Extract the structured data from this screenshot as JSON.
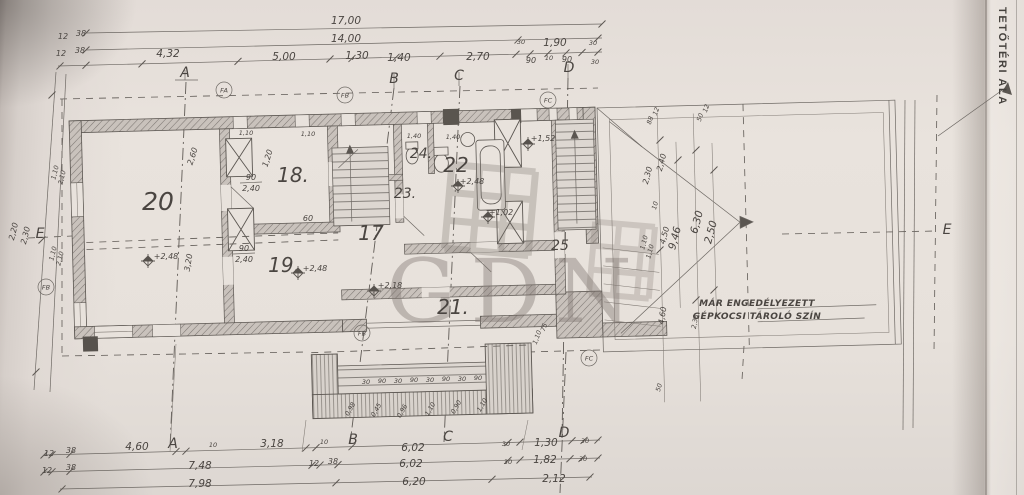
{
  "sheet": {
    "side_title": "TETŐTÉRI ALA",
    "watermark": "GDN"
  },
  "plan": {
    "texts": [
      {
        "t": "17,00",
        "x": 346,
        "y": 24,
        "s": "m"
      },
      {
        "t": "14,00",
        "x": 346,
        "y": 42,
        "s": "m"
      },
      {
        "t": "4,32",
        "x": 168,
        "y": 57,
        "s": "m"
      },
      {
        "t": "5,00",
        "x": 284,
        "y": 60,
        "s": "m"
      },
      {
        "t": "1,30",
        "x": 357,
        "y": 59,
        "s": "m"
      },
      {
        "t": "1,40",
        "x": 399,
        "y": 61,
        "s": "m"
      },
      {
        "t": "2,70",
        "x": 478,
        "y": 60,
        "s": "m"
      },
      {
        "t": "1,90",
        "x": 555,
        "y": 46,
        "s": "m"
      },
      {
        "t": "30",
        "x": 521,
        "y": 44,
        "s": "xs"
      },
      {
        "t": "30",
        "x": 593,
        "y": 45,
        "s": "xs"
      },
      {
        "t": "90",
        "x": 531,
        "y": 63,
        "s": "s"
      },
      {
        "t": "10",
        "x": 549,
        "y": 60,
        "s": "xs"
      },
      {
        "t": "90",
        "x": 567,
        "y": 62,
        "s": "s"
      },
      {
        "t": "30",
        "x": 595,
        "y": 64,
        "s": "xs"
      },
      {
        "t": "12",
        "x": 63,
        "y": 39,
        "s": "s"
      },
      {
        "t": "38",
        "x": 81,
        "y": 36,
        "s": "s"
      },
      {
        "t": "12",
        "x": 61,
        "y": 56,
        "s": "s"
      },
      {
        "t": "38",
        "x": 80,
        "y": 53,
        "s": "s"
      },
      {
        "t": "A",
        "x": 185,
        "y": 77,
        "s": "l"
      },
      {
        "t": "B",
        "x": 394,
        "y": 83,
        "s": "l"
      },
      {
        "t": "C",
        "x": 459,
        "y": 80,
        "s": "l"
      },
      {
        "t": "D",
        "x": 569,
        "y": 72,
        "s": "l"
      },
      {
        "t": "A",
        "x": 173,
        "y": 448,
        "s": "l"
      },
      {
        "t": "B",
        "x": 353,
        "y": 444,
        "s": "l"
      },
      {
        "t": "C",
        "x": 448,
        "y": 441,
        "s": "l"
      },
      {
        "t": "D",
        "x": 564,
        "y": 437,
        "s": "l"
      },
      {
        "t": "E",
        "x": 40,
        "y": 238,
        "s": "l"
      },
      {
        "t": "E",
        "x": 947,
        "y": 234,
        "s": "l"
      },
      {
        "t": "20",
        "x": 158,
        "y": 210,
        "s": "xxl"
      },
      {
        "t": "18.",
        "x": 293,
        "y": 182,
        "s": "xl"
      },
      {
        "t": "19.",
        "x": 284,
        "y": 272,
        "s": "xl"
      },
      {
        "t": "17",
        "x": 371,
        "y": 240,
        "s": "xl"
      },
      {
        "t": "21.",
        "x": 453,
        "y": 314,
        "s": "xl"
      },
      {
        "t": "22",
        "x": 456,
        "y": 172,
        "s": "xl"
      },
      {
        "t": "23.",
        "x": 405,
        "y": 198,
        "s": "l"
      },
      {
        "t": "24.",
        "x": 421,
        "y": 158,
        "s": "l"
      },
      {
        "t": "25",
        "x": 560,
        "y": 250,
        "s": "l"
      },
      {
        "t": "+2,48",
        "x": 166,
        "y": 259,
        "s": "s"
      },
      {
        "t": "+2,48",
        "x": 315,
        "y": 271,
        "s": "s"
      },
      {
        "t": "+2,18",
        "x": 390,
        "y": 288,
        "s": "s"
      },
      {
        "t": "+1,52",
        "x": 543,
        "y": 141,
        "s": "s"
      },
      {
        "t": "+1,02",
        "x": 501,
        "y": 215,
        "s": "s"
      },
      {
        "t": "+2,48",
        "x": 472,
        "y": 184,
        "s": "s"
      },
      {
        "t": "2,60",
        "x": 195,
        "y": 157,
        "r": -72,
        "s": "s"
      },
      {
        "t": "1,20",
        "x": 270,
        "y": 159,
        "r": -72,
        "s": "s"
      },
      {
        "t": "3,20",
        "x": 191,
        "y": 263,
        "r": -80,
        "s": "s"
      },
      {
        "t": "60",
        "x": 308,
        "y": 221,
        "s": "s"
      },
      {
        "t": "1,40",
        "x": 414,
        "y": 138,
        "s": "xs"
      },
      {
        "t": "1,40",
        "x": 453,
        "y": 139,
        "s": "xs"
      },
      {
        "t": "1,10",
        "x": 246,
        "y": 135,
        "s": "xs"
      },
      {
        "t": "1,10",
        "x": 308,
        "y": 136,
        "s": "xs"
      },
      {
        "t": "1,10",
        "x": 539,
        "y": 338,
        "r": -70,
        "s": "xs"
      },
      {
        "t": "75",
        "x": 546,
        "y": 328,
        "r": -70,
        "s": "xs"
      },
      {
        "t": "2,20",
        "x": 16,
        "y": 232,
        "r": -76,
        "s": "s"
      },
      {
        "t": "2,30",
        "x": 28,
        "y": 236,
        "r": -76,
        "s": "s"
      },
      {
        "t": "1,10",
        "x": 57,
        "y": 173,
        "r": -76,
        "s": "xs"
      },
      {
        "t": "2,10",
        "x": 64,
        "y": 178,
        "r": -76,
        "s": "xs"
      },
      {
        "t": "1,10",
        "x": 55,
        "y": 254,
        "r": -76,
        "s": "xs"
      },
      {
        "t": "2,10",
        "x": 62,
        "y": 259,
        "r": -76,
        "s": "xs"
      },
      {
        "t": "2,30",
        "x": 650,
        "y": 176,
        "r": -75,
        "s": "s"
      },
      {
        "t": "2,40",
        "x": 664,
        "y": 163,
        "r": -75,
        "s": "s"
      },
      {
        "t": "6,30",
        "x": 700,
        "y": 223,
        "r": -75,
        "s": "m"
      },
      {
        "t": "2,50",
        "x": 714,
        "y": 233,
        "r": -75,
        "s": "m"
      },
      {
        "t": "9,46",
        "x": 678,
        "y": 239,
        "r": -75,
        "s": "m"
      },
      {
        "t": "4,50",
        "x": 667,
        "y": 236,
        "r": -75,
        "s": "s"
      },
      {
        "t": "1,10",
        "x": 646,
        "y": 243,
        "r": -75,
        "s": "xs"
      },
      {
        "t": "1,10",
        "x": 652,
        "y": 252,
        "r": -75,
        "s": "xs"
      },
      {
        "t": "10",
        "x": 657,
        "y": 206,
        "r": -75,
        "s": "xs"
      },
      {
        "t": "4,60",
        "x": 665,
        "y": 316,
        "r": -80,
        "s": "s"
      },
      {
        "t": "2,38",
        "x": 697,
        "y": 322,
        "r": -80,
        "s": "xs"
      },
      {
        "t": "50",
        "x": 661,
        "y": 388,
        "r": -75,
        "s": "xs"
      },
      {
        "t": "88",
        "x": 652,
        "y": 121,
        "r": -70,
        "s": "xs"
      },
      {
        "t": "12",
        "x": 658,
        "y": 112,
        "r": -70,
        "s": "xs"
      },
      {
        "t": "50",
        "x": 702,
        "y": 118,
        "r": -70,
        "s": "xs"
      },
      {
        "t": "12",
        "x": 708,
        "y": 109,
        "r": -70,
        "s": "xs"
      },
      {
        "t": "MÁR ENGEDÉLYEZETT",
        "x": 757,
        "y": 306,
        "s": "note",
        "a": "start"
      },
      {
        "t": "GÉPKOCSI TÁROLÓ SZÍN",
        "x": 757,
        "y": 319,
        "s": "note",
        "a": "start"
      },
      {
        "t": "12",
        "x": 49,
        "y": 456,
        "s": "s"
      },
      {
        "t": "38",
        "x": 71,
        "y": 453,
        "s": "s"
      },
      {
        "t": "4,60",
        "x": 137,
        "y": 450,
        "s": "m"
      },
      {
        "t": "10",
        "x": 213,
        "y": 447,
        "s": "xs"
      },
      {
        "t": "3,18",
        "x": 272,
        "y": 447,
        "s": "m"
      },
      {
        "t": "10",
        "x": 324,
        "y": 444,
        "s": "xs"
      },
      {
        "t": "6,02",
        "x": 413,
        "y": 451,
        "s": "m"
      },
      {
        "t": "30",
        "x": 506,
        "y": 446,
        "s": "xs"
      },
      {
        "t": "1,30",
        "x": 546,
        "y": 446,
        "s": "m"
      },
      {
        "t": "30",
        "x": 585,
        "y": 443,
        "s": "xs"
      },
      {
        "t": "12",
        "x": 47,
        "y": 473,
        "s": "s"
      },
      {
        "t": "38",
        "x": 71,
        "y": 470,
        "s": "s"
      },
      {
        "t": "7,48",
        "x": 200,
        "y": 469,
        "s": "m"
      },
      {
        "t": "12",
        "x": 314,
        "y": 466,
        "s": "s"
      },
      {
        "t": "38",
        "x": 333,
        "y": 464,
        "s": "s"
      },
      {
        "t": "6,02",
        "x": 411,
        "y": 467,
        "s": "m"
      },
      {
        "t": "30",
        "x": 508,
        "y": 464,
        "s": "xs"
      },
      {
        "t": "1,82",
        "x": 545,
        "y": 463,
        "s": "m"
      },
      {
        "t": "30",
        "x": 583,
        "y": 461,
        "s": "xs"
      },
      {
        "t": "7,98",
        "x": 200,
        "y": 487,
        "s": "m"
      },
      {
        "t": "6,20",
        "x": 414,
        "y": 485,
        "s": "m"
      },
      {
        "t": "2,12",
        "x": 554,
        "y": 482,
        "s": "m"
      },
      {
        "t": "30",
        "x": 366,
        "y": 384,
        "s": "xs"
      },
      {
        "t": "90",
        "x": 382,
        "y": 383,
        "s": "xs"
      },
      {
        "t": "30",
        "x": 398,
        "y": 383,
        "s": "xs"
      },
      {
        "t": "90",
        "x": 414,
        "y": 382,
        "s": "xs"
      },
      {
        "t": "30",
        "x": 430,
        "y": 382,
        "s": "xs"
      },
      {
        "t": "90",
        "x": 446,
        "y": 381,
        "s": "xs"
      },
      {
        "t": "30",
        "x": 462,
        "y": 381,
        "s": "xs"
      },
      {
        "t": "90",
        "x": 478,
        "y": 380,
        "s": "xs"
      },
      {
        "t": "0,98",
        "x": 352,
        "y": 410,
        "r": -60,
        "s": "xs"
      },
      {
        "t": "0,45",
        "x": 378,
        "y": 411,
        "r": -60,
        "s": "xs"
      },
      {
        "t": "0,96",
        "x": 404,
        "y": 412,
        "r": -60,
        "s": "xs"
      },
      {
        "t": "1,10",
        "x": 432,
        "y": 410,
        "r": -60,
        "s": "xs"
      },
      {
        "t": "0,90",
        "x": 458,
        "y": 408,
        "r": -60,
        "s": "xs"
      },
      {
        "t": "1,10",
        "x": 484,
        "y": 406,
        "r": -60,
        "s": "xs"
      }
    ],
    "fracs": [
      {
        "x": 251,
        "y": 182,
        "top": "90",
        "bot": "2,40"
      },
      {
        "x": 244,
        "y": 253,
        "top": "90",
        "bot": "2,40"
      }
    ],
    "circles": [
      {
        "t": "FA",
        "x": 224,
        "y": 90
      },
      {
        "t": "FB",
        "x": 345,
        "y": 95
      },
      {
        "t": "FC",
        "x": 548,
        "y": 100
      },
      {
        "t": "FB",
        "x": 362,
        "y": 333
      },
      {
        "t": "FC",
        "x": 589,
        "y": 358
      },
      {
        "t": "FB",
        "x": 46,
        "y": 287
      }
    ],
    "level_marks": [
      {
        "x": 148,
        "y": 261
      },
      {
        "x": 298,
        "y": 273
      },
      {
        "x": 374,
        "y": 291
      },
      {
        "x": 528,
        "y": 144
      },
      {
        "x": 488,
        "y": 217
      },
      {
        "x": 458,
        "y": 186
      }
    ]
  }
}
